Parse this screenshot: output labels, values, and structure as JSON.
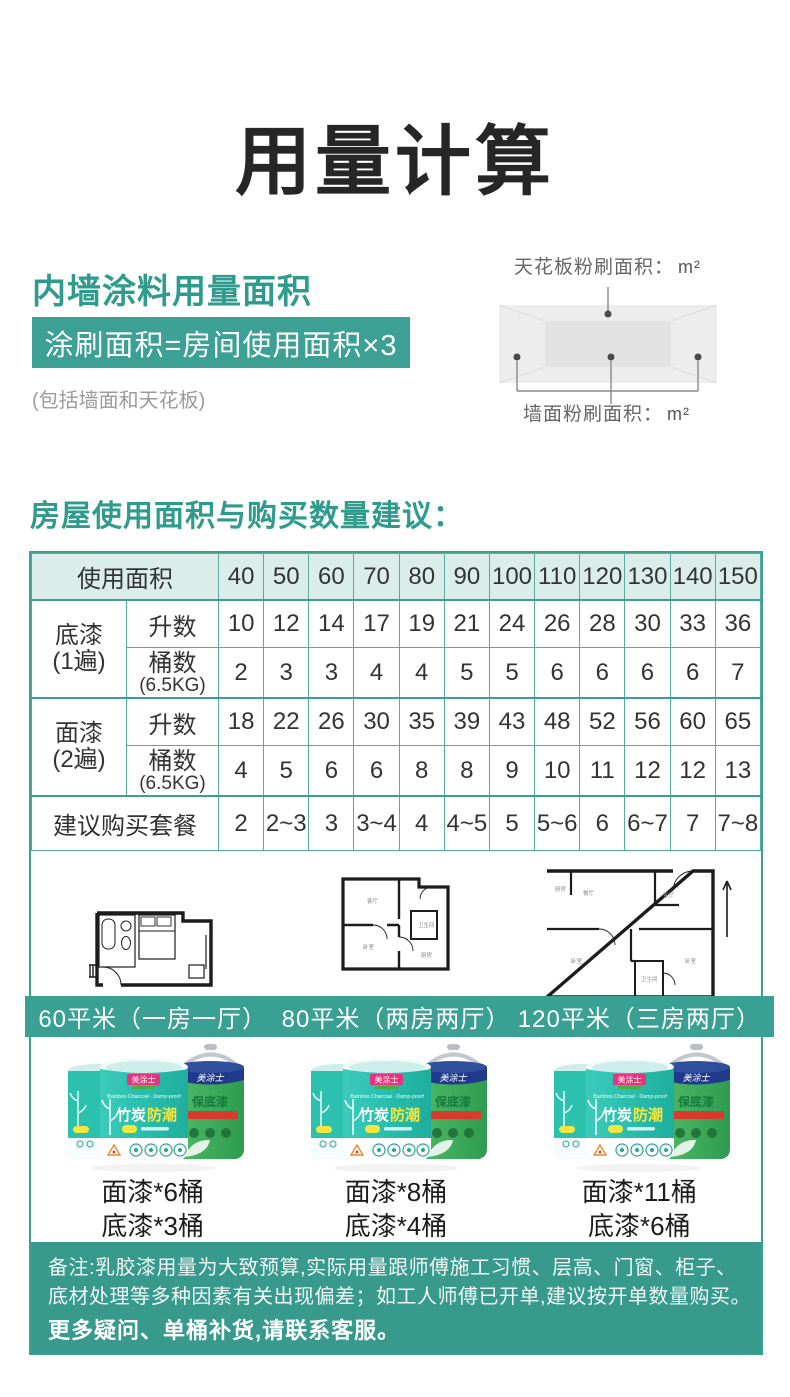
{
  "page": {
    "title": "用量计算"
  },
  "section_usage": {
    "heading": "内墙涂料用量面积",
    "formula": "涂刷面积=房间使用面积×3",
    "note": "(包括墙面和天花板)",
    "diagram": {
      "ceiling_label": "天花板粉刷面积：",
      "wall_label": "墙面粉刷面积：",
      "unit": "m²"
    }
  },
  "section_table": {
    "heading": "房屋使用面积与购买数量建议："
  },
  "table": {
    "area_label": "使用面积",
    "areas": [
      "40",
      "50",
      "60",
      "70",
      "80",
      "90",
      "100",
      "110",
      "120",
      "130",
      "140",
      "150"
    ],
    "primer_name": "底漆",
    "primer_pass": "(1遍)",
    "topcoat_name": "面漆",
    "topcoat_pass": "(2遍)",
    "liters_label": "升数",
    "buckets_label": "桶数",
    "buckets_sub": "(6.5KG)",
    "primer_liters": [
      "10",
      "12",
      "14",
      "17",
      "19",
      "21",
      "24",
      "26",
      "28",
      "30",
      "33",
      "36"
    ],
    "primer_buckets": [
      "2",
      "3",
      "3",
      "4",
      "4",
      "5",
      "5",
      "6",
      "6",
      "6",
      "6",
      "7"
    ],
    "topcoat_liters": [
      "18",
      "22",
      "26",
      "30",
      "35",
      "39",
      "43",
      "48",
      "52",
      "56",
      "60",
      "65"
    ],
    "topcoat_buckets": [
      "4",
      "5",
      "6",
      "6",
      "8",
      "8",
      "9",
      "10",
      "11",
      "12",
      "12",
      "13"
    ],
    "suggest_label": "建议购买套餐",
    "suggest": [
      "2",
      "2~3",
      "3",
      "3~4",
      "4",
      "4~5",
      "5",
      "5~6",
      "6",
      "6~7",
      "7",
      "7~8"
    ]
  },
  "plans": [
    {
      "caption": "60平米（一房一厅）"
    },
    {
      "caption": "80平米（两房两厅）",
      "rooms": {
        "living": "客厅",
        "bed": "卧室",
        "kitchen": "厨房",
        "bath": "卫生间"
      }
    },
    {
      "caption": "120平米（三房两厅）",
      "rooms": {
        "dining": "餐厅",
        "living": "客厅",
        "bed1": "卧室",
        "bed2": "卧室",
        "bath": "卫生间",
        "kitchen": "厨房"
      }
    }
  ],
  "product": {
    "brand": "美涂士",
    "name_part1": "竹炭",
    "name_part2": "防潮",
    "subtitle": "Bamboo Charcoal · Damp-proof",
    "primer_label": "保底漆"
  },
  "packages": [
    {
      "topcoat": "面漆*6桶",
      "primer": "底漆*3桶"
    },
    {
      "topcoat": "面漆*8桶",
      "primer": "底漆*4桶"
    },
    {
      "topcoat": "面漆*11桶",
      "primer": "底漆*6桶"
    }
  ],
  "footer": {
    "line1": "备注:乳胶漆用量为大致预算,实际用量跟师傅施工习惯、层高、门窗、柜子、",
    "line2": "底材处理等多种因素有关出现偏差；如工人师傅已开单,建议按开单数量购买。",
    "line3": "更多疑问、单桶补货,请联系客服。"
  },
  "colors": {
    "teal_heading": "#2e9b8c",
    "formula_bg": "#3ca094",
    "table_border": "#58aaa0",
    "table_header_bg": "#dbede9",
    "caption_bg": "#3aa094",
    "footer_bg": "#379a8c",
    "bucket_teal": "#2cc2b1",
    "bucket_green": "#3fae5c",
    "bucket_navy": "#20398b",
    "brand_pink": "#e6337e",
    "accent_yellow": "#f5e73d"
  }
}
